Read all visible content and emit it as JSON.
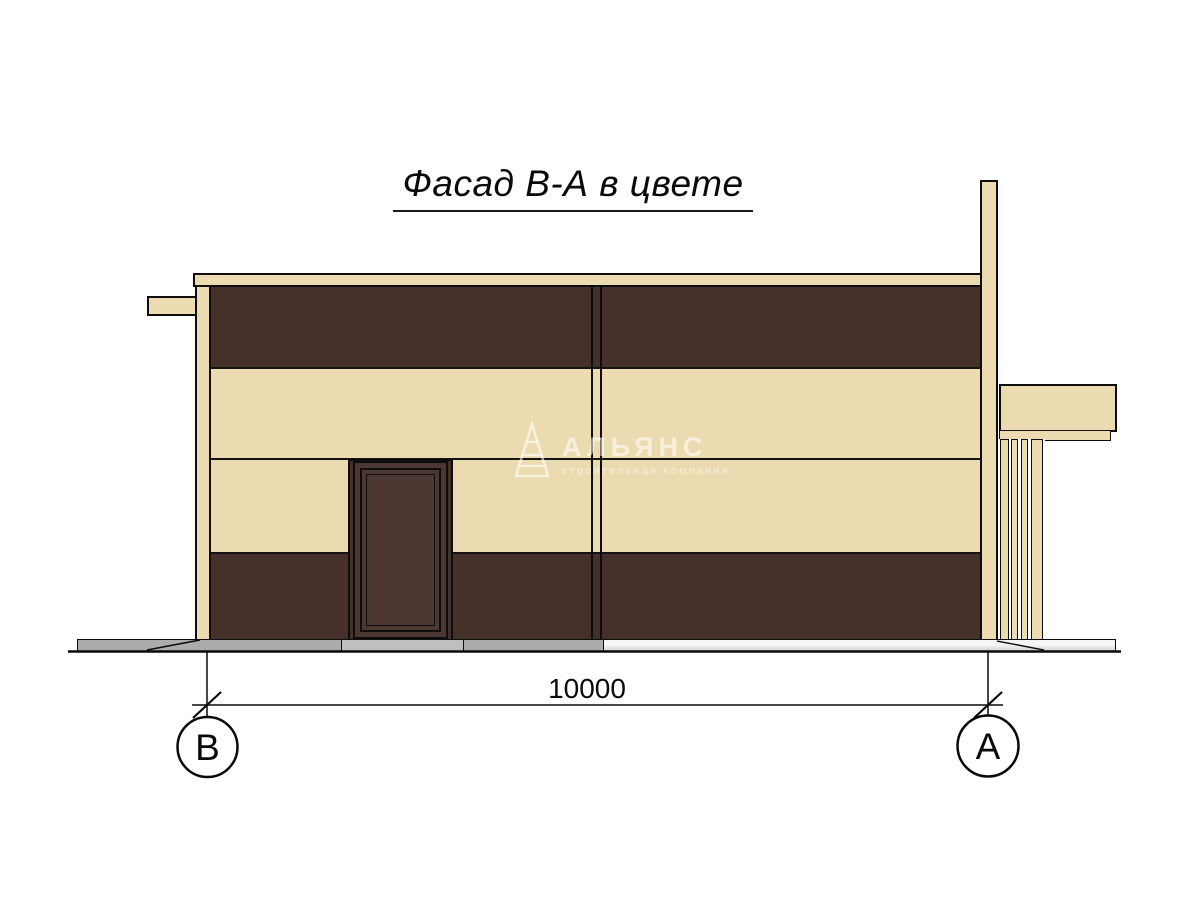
{
  "drawing": {
    "title": "Фасад В-А в цвете",
    "dimension": {
      "value": "10000"
    },
    "axis_markers": {
      "left": "В",
      "right": "А"
    },
    "watermark": {
      "brand": "АЛЬЯНС",
      "tagline": "строительная компания"
    },
    "palette": {
      "facade_cream": "#ecdbb0",
      "facade_brown": "#46312a",
      "door_brown": "#4c3732",
      "plinth_gray": "#a9abad",
      "threshold_gray": "#bdbfc1",
      "outline": "#0d0d0d"
    }
  }
}
